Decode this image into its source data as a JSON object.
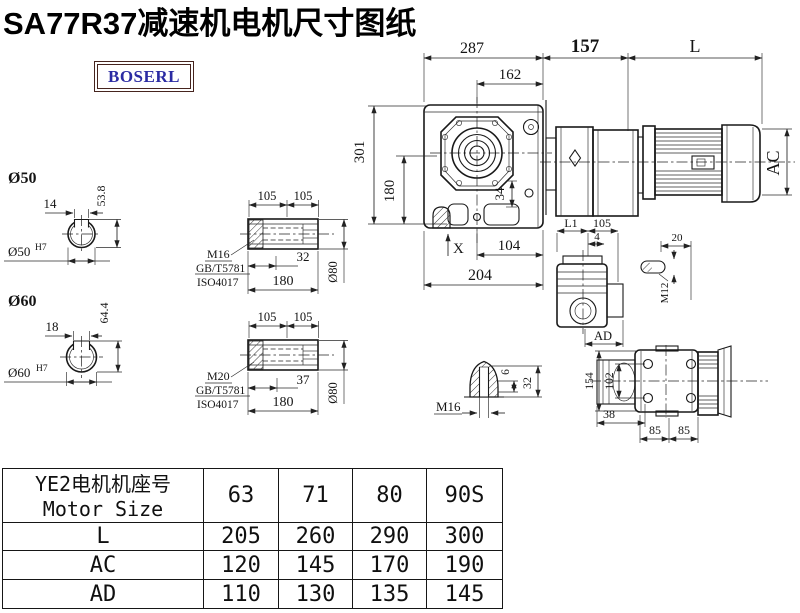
{
  "title": "SA77R37减速机电机尺寸图纸",
  "logo": {
    "text": "BOSERL"
  },
  "drawing": {
    "overall": {
      "w287": "287",
      "w162": "162",
      "w157": "157",
      "wL": "L",
      "h301": "301",
      "h180": "180",
      "d34": "34",
      "posX": "X",
      "w104": "104",
      "w204": "204",
      "hAC": "AC"
    },
    "solid_shaft_50": {
      "dia": "Ø50",
      "key_w": "14",
      "key_h": "53.8",
      "bore": "Ø50",
      "bore_fit": "H7"
    },
    "solid_shaft_60": {
      "dia": "Ø60",
      "key_w": "18",
      "key_h": "64.4",
      "bore": "Ø60",
      "bore_fit": "H7"
    },
    "hollow_shaft_a": {
      "l1": "105",
      "l2": "105",
      "thread": "M16",
      "std1": "GB/T5781",
      "std2": "ISO4017",
      "depth": "32",
      "len": "180",
      "dia": "Ø80"
    },
    "hollow_shaft_b": {
      "l1": "105",
      "l2": "105",
      "thread": "M20",
      "std1": "GB/T5781",
      "std2": "ISO4017",
      "depth": "37",
      "len": "180",
      "dia": "Ø80"
    },
    "shaft_view": {
      "wL1": "L1",
      "w105": "105",
      "w4": "4",
      "wAD": "AD"
    },
    "key_detail": {
      "len": "20",
      "thread": "M12"
    },
    "top_view": {
      "h154": "154",
      "h102": "102",
      "w38": "38",
      "w85a": "85",
      "w85b": "85"
    },
    "plug_detail": {
      "h6": "6",
      "h32": "32",
      "thread": "M16"
    }
  },
  "table": {
    "header": {
      "cn": "YE2电机机座号",
      "en": "Motor Size"
    },
    "sizes": [
      "63",
      "71",
      "80",
      "90S"
    ],
    "rows": [
      {
        "label": "L",
        "values": [
          "205",
          "260",
          "290",
          "300"
        ]
      },
      {
        "label": "AC",
        "values": [
          "120",
          "145",
          "170",
          "190"
        ]
      },
      {
        "label": "AD",
        "values": [
          "110",
          "130",
          "135",
          "145"
        ]
      }
    ]
  }
}
